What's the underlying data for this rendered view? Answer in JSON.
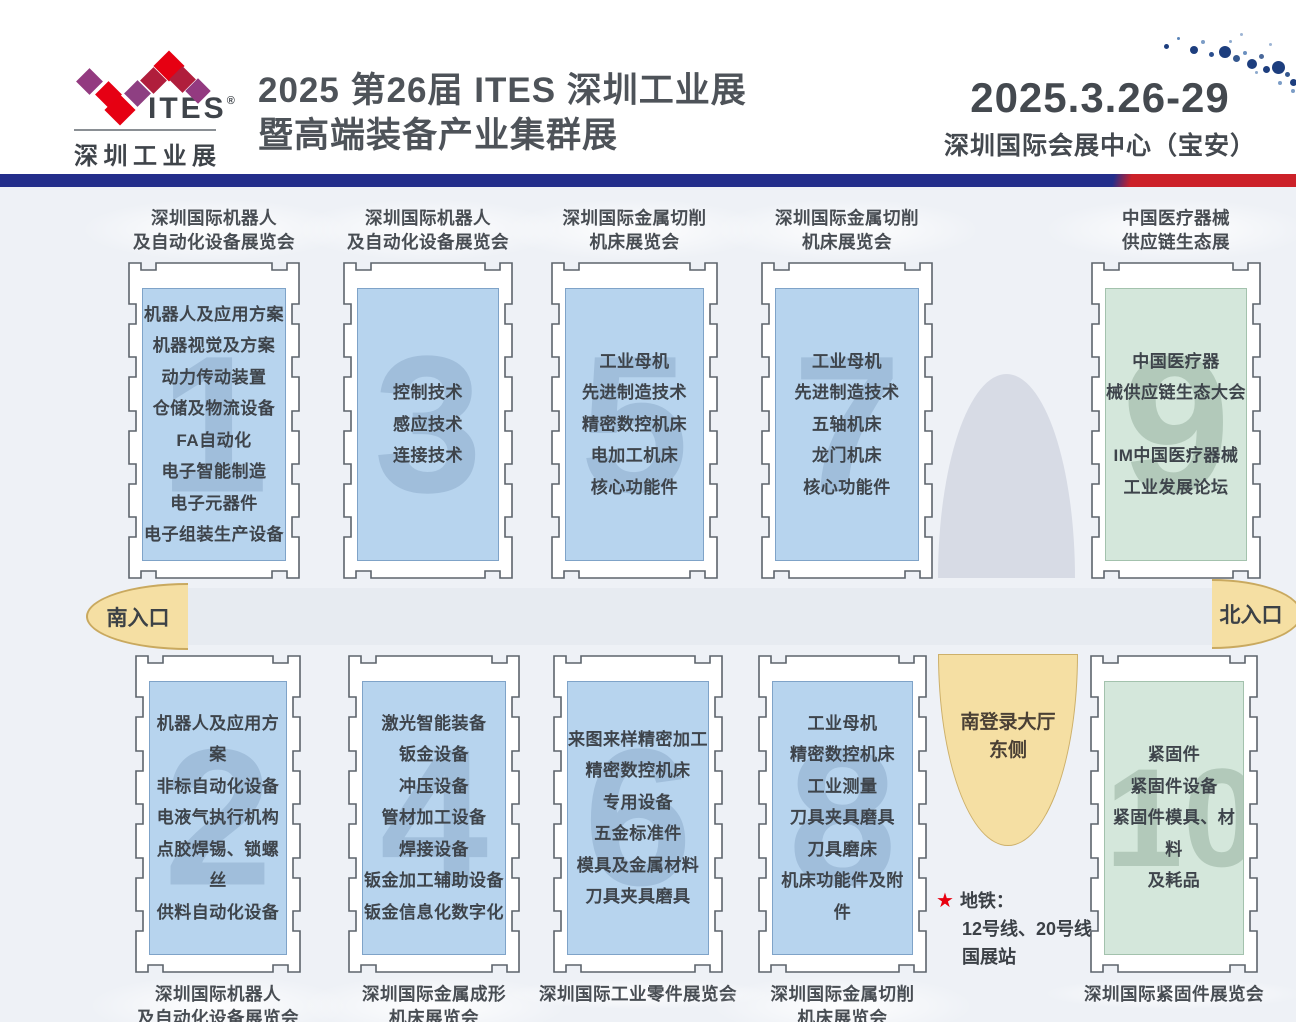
{
  "header": {
    "logo_brand": "ITES",
    "logo_reg": "®",
    "logo_subtitle": "深圳工业展",
    "title_line1": "2025 第26届 ITES 深圳工业展",
    "title_line2": "暨高端装备产业集群展",
    "date": "2025.3.26-29",
    "venue": "深圳国际会展中心（宝安）"
  },
  "entrances": {
    "south": "南入口",
    "north": "北入口"
  },
  "lobby": {
    "line1": "南登录大厅",
    "line2": "东侧"
  },
  "metro": {
    "star": "★",
    "label": "地铁：",
    "lines": "12号线、20号线",
    "station": "国展站"
  },
  "colors": {
    "bar_blue": "#232e8b",
    "bar_red": "#cc2129",
    "hall_blue": "#b7d4ee",
    "hall_green": "#d4e7db",
    "entrance_tan": "#f5dfa3",
    "star_red": "#e8000f"
  },
  "halls_top": [
    {
      "number": "1",
      "color": "blue",
      "label": [
        "深圳国际机器人",
        "及自动化设备展览会"
      ],
      "items": [
        "机器人及应用方案",
        "机器视觉及方案",
        "动力传动装置",
        "仓储及物流设备",
        "FA自动化",
        "电子智能制造",
        "电子元器件",
        "电子组装生产设备"
      ]
    },
    {
      "number": "3",
      "color": "blue",
      "label": [
        "深圳国际机器人",
        "及自动化设备展览会"
      ],
      "items": [
        "控制技术",
        "感应技术",
        "连接技术"
      ]
    },
    {
      "number": "5",
      "color": "blue",
      "label": [
        "深圳国际金属切削",
        "机床展览会"
      ],
      "items": [
        "工业母机",
        "先进制造技术",
        "精密数控机床",
        "电加工机床",
        "核心功能件"
      ]
    },
    {
      "number": "7",
      "color": "blue",
      "label": [
        "深圳国际金属切削",
        "机床展览会"
      ],
      "items": [
        "工业母机",
        "先进制造技术",
        "五轴机床",
        "龙门机床",
        "核心功能件"
      ]
    },
    {
      "number": "9",
      "color": "green",
      "label": [
        "中国医疗器械",
        "供应链生态展"
      ],
      "items": [
        "中国医疗器",
        "械供应链生态大会",
        "",
        "IM中国医疗器械",
        "工业发展论坛"
      ]
    }
  ],
  "halls_bottom": [
    {
      "number": "2",
      "color": "blue",
      "label": [
        "深圳国际机器人",
        "及自动化设备展览会"
      ],
      "items": [
        "机器人及应用方案",
        "非标自动化设备",
        "电液气执行机构",
        "点胶焊锡、锁螺丝",
        "供料自动化设备"
      ]
    },
    {
      "number": "4",
      "color": "blue",
      "label": [
        "深圳国际金属成形",
        "机床展览会"
      ],
      "items": [
        "激光智能装备",
        "钣金设备",
        "冲压设备",
        "管材加工设备",
        "焊接设备",
        "钣金加工辅助设备",
        "钣金信息化数字化"
      ]
    },
    {
      "number": "6",
      "color": "blue",
      "label": [
        "深圳国际工业零件展览会"
      ],
      "items": [
        "来图来样精密加工",
        "精密数控机床",
        "专用设备",
        "五金标准件",
        "模具及金属材料",
        "刀具夹具磨具"
      ]
    },
    {
      "number": "8",
      "color": "blue",
      "label": [
        "深圳国际金属切削",
        "机床展览会"
      ],
      "items": [
        "工业母机",
        "精密数控机床",
        "工业测量",
        "刀具夹具磨具",
        "刀具磨床",
        "机床功能件及附件"
      ]
    },
    {
      "number": "10",
      "color": "green",
      "label": [
        "深圳国际紧固件展览会"
      ],
      "items": [
        "紧固件",
        "紧固件设备",
        "紧固件模具、材料",
        "及耗品"
      ]
    }
  ]
}
